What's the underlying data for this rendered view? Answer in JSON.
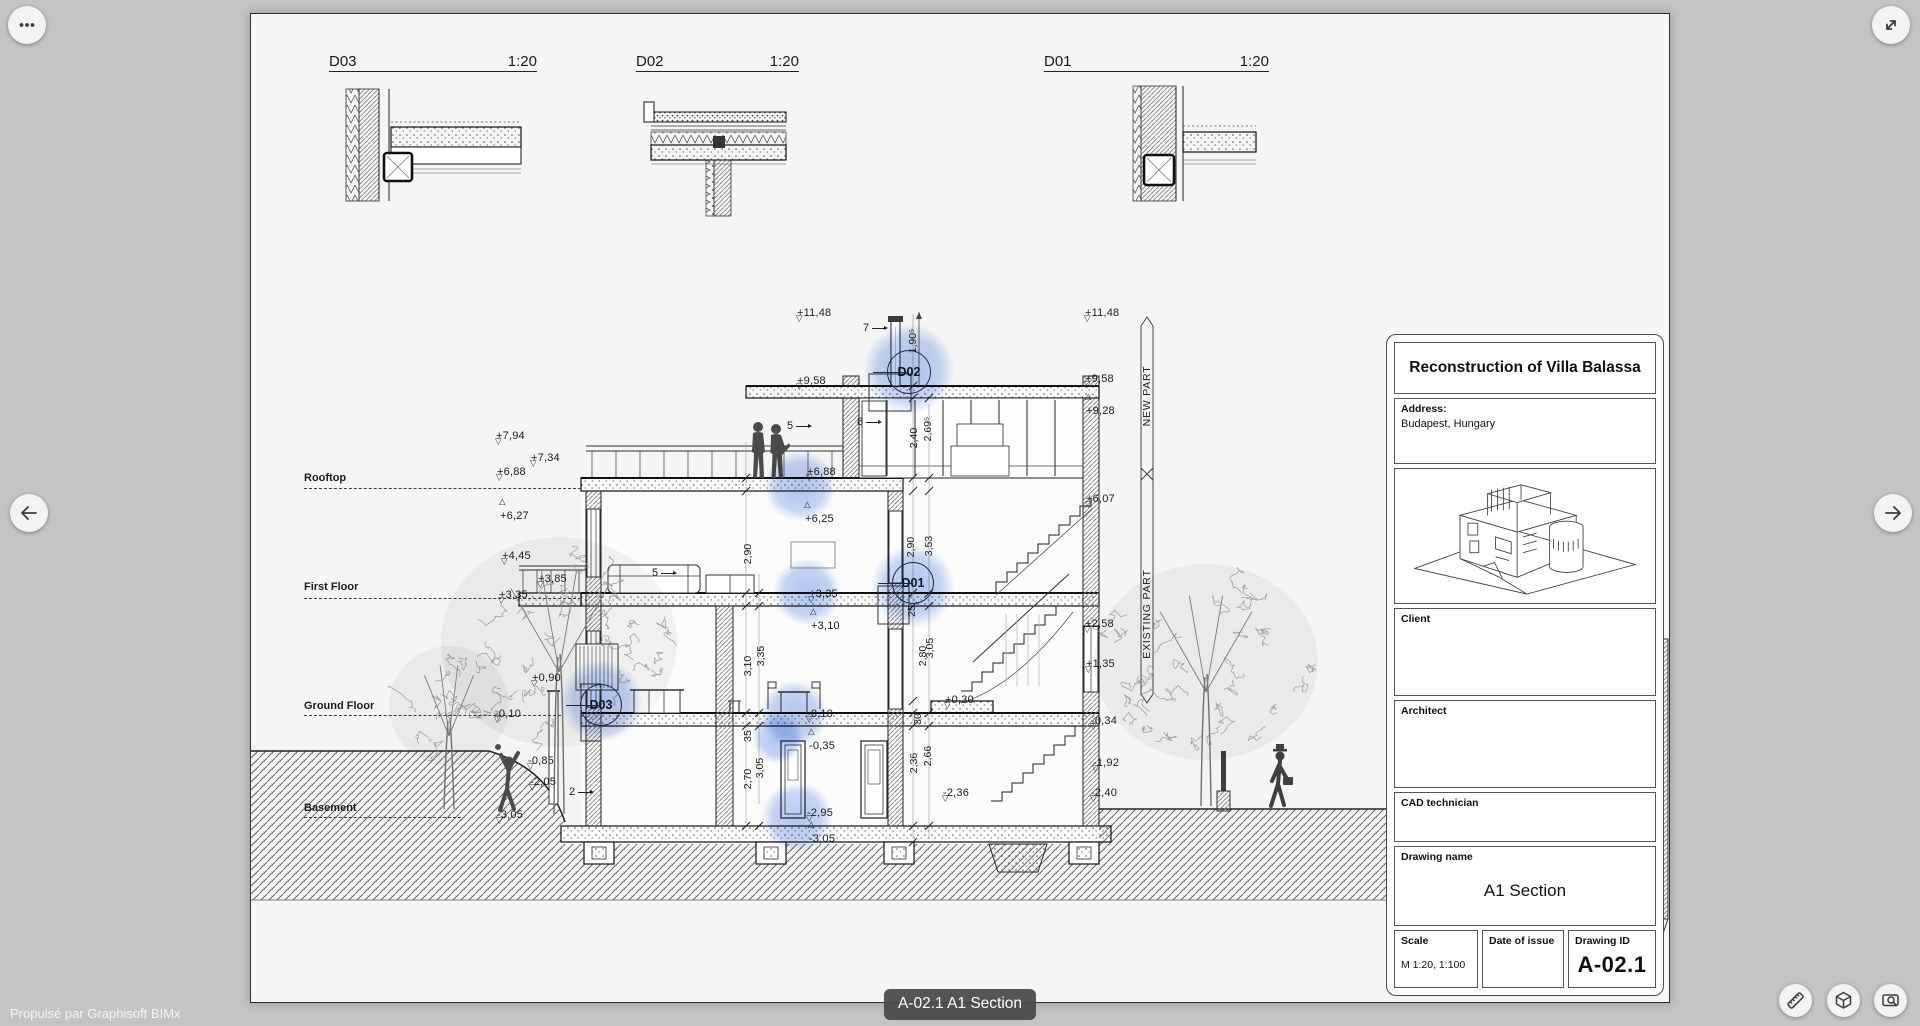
{
  "chrome": {
    "powered_by": "Propulsé par Graphisoft BIMx",
    "sheet_pill": "A-02.1 A1 Section",
    "icons": {
      "more": "more-options-icon",
      "expand": "fullscreen-expand-icon",
      "prev": "previous-sheet-arrow-icon",
      "next": "next-sheet-arrow-icon",
      "measure": "ruler-icon",
      "model": "3d-cube-icon",
      "magnify": "sheet-zoom-icon"
    }
  },
  "details": [
    {
      "id": "D03",
      "scale": "1:20",
      "x": 78,
      "w": 208
    },
    {
      "id": "D02",
      "scale": "1:20",
      "x": 385,
      "w": 163
    },
    {
      "id": "D01",
      "scale": "1:20",
      "x": 793,
      "w": 225
    }
  ],
  "section": {
    "floors": [
      {
        "label": "Rooftop",
        "x": 53,
        "y": 458,
        "ly": 474,
        "lw": 277
      },
      {
        "label": "First Floor",
        "x": 53,
        "y": 567,
        "ly": 584,
        "lw": 277
      },
      {
        "label": "Ground Floor",
        "x": 53,
        "y": 686,
        "ly": 701,
        "lw": 257
      },
      {
        "label": "Basement",
        "x": 53,
        "y": 788,
        "ly": 803,
        "lw": 157
      }
    ],
    "markers": [
      {
        "t": "+7,94",
        "x": 245,
        "y": 412,
        "d": "dn"
      },
      {
        "t": "+7,34",
        "x": 280,
        "y": 434,
        "d": "dn"
      },
      {
        "t": "+6,88",
        "x": 246,
        "y": 448,
        "d": "dn"
      },
      {
        "t": "+6,27",
        "x": 249,
        "y": 492,
        "d": "up"
      },
      {
        "t": "+4,45",
        "x": 251,
        "y": 532,
        "d": "dn"
      },
      {
        "t": "+3,85",
        "x": 287,
        "y": 555,
        "d": "dn"
      },
      {
        "t": "+3,35",
        "x": 248,
        "y": 571,
        "d": "dn"
      },
      {
        "t": "+0,90",
        "x": 281,
        "y": 654,
        "d": "dn"
      },
      {
        "t": "-0,10",
        "x": 244,
        "y": 690,
        "d": "dn"
      },
      {
        "t": "-0,85",
        "x": 277,
        "y": 737,
        "d": "dn"
      },
      {
        "t": "-2,05",
        "x": 279,
        "y": 758,
        "d": "dn"
      },
      {
        "t": "-3,05",
        "x": 246,
        "y": 791,
        "d": "dn"
      },
      {
        "t": "+11,48",
        "x": 546,
        "y": 289,
        "d": "dn"
      },
      {
        "t": "+9,58",
        "x": 546,
        "y": 357,
        "d": "dn"
      },
      {
        "t": "+6,88",
        "x": 556,
        "y": 448,
        "d": "dn"
      },
      {
        "t": "+6,25",
        "x": 554,
        "y": 495,
        "d": "up"
      },
      {
        "t": "+3,35",
        "x": 558,
        "y": 570,
        "d": "dn"
      },
      {
        "t": "+3,10",
        "x": 560,
        "y": 602,
        "d": "up"
      },
      {
        "t": "-0,10",
        "x": 556,
        "y": 690,
        "d": "dn"
      },
      {
        "t": "-0,35",
        "x": 558,
        "y": 722,
        "d": "up"
      },
      {
        "t": "-2,95",
        "x": 556,
        "y": 789,
        "d": "dn"
      },
      {
        "t": "-3,05",
        "x": 558,
        "y": 815,
        "d": "up"
      },
      {
        "t": "+0,30",
        "x": 694,
        "y": 676,
        "d": "dn"
      },
      {
        "t": "-2,36",
        "x": 692,
        "y": 769,
        "d": "dn"
      },
      {
        "t": "+11,48",
        "x": 834,
        "y": 289,
        "d": "dn"
      },
      {
        "t": "+9,58",
        "x": 834,
        "y": 355,
        "d": "dn"
      },
      {
        "t": "+9,28",
        "x": 835,
        "y": 387,
        "d": "up"
      },
      {
        "t": "+6,07",
        "x": 835,
        "y": 475,
        "d": "dn"
      },
      {
        "t": "+2,58",
        "x": 834,
        "y": 600,
        "d": "dn"
      },
      {
        "t": "+1,35",
        "x": 835,
        "y": 640,
        "d": "dn"
      },
      {
        "t": "-0,34",
        "x": 840,
        "y": 697,
        "d": "dn"
      },
      {
        "t": "-1,92",
        "x": 842,
        "y": 739,
        "d": "dn"
      },
      {
        "t": "-2,40",
        "x": 840,
        "y": 769,
        "d": "dn"
      }
    ],
    "dims": [
      {
        "t": "2,90",
        "x": 497,
        "y": 540
      },
      {
        "t": "3,10",
        "x": 497,
        "y": 652
      },
      {
        "t": "3,35",
        "x": 510,
        "y": 642
      },
      {
        "t": "35",
        "x": 497,
        "y": 722
      },
      {
        "t": "2,70",
        "x": 497,
        "y": 765
      },
      {
        "t": "3,05",
        "x": 509,
        "y": 754
      },
      {
        "t": "1,90⁵",
        "x": 662,
        "y": 327
      },
      {
        "t": "2,40",
        "x": 663,
        "y": 424
      },
      {
        "t": "2,69⁵",
        "x": 677,
        "y": 415
      },
      {
        "t": "2,90",
        "x": 660,
        "y": 533
      },
      {
        "t": "3,53",
        "x": 678,
        "y": 532
      },
      {
        "t": "25",
        "x": 661,
        "y": 597
      },
      {
        "t": "2,80",
        "x": 672,
        "y": 642
      },
      {
        "t": "3,05",
        "x": 679,
        "y": 634
      },
      {
        "t": "30",
        "x": 667,
        "y": 705
      },
      {
        "t": "2,36",
        "x": 663,
        "y": 749
      },
      {
        "t": "2,66",
        "x": 677,
        "y": 742
      }
    ],
    "callouts": [
      {
        "t": "7",
        "x": 612,
        "y": 308
      },
      {
        "t": "8",
        "x": 606,
        "y": 402
      },
      {
        "t": "5",
        "x": 536,
        "y": 406
      },
      {
        "t": "5",
        "x": 401,
        "y": 553
      },
      {
        "t": "2",
        "x": 318,
        "y": 772
      }
    ],
    "parts": [
      {
        "t": "NEW PART",
        "x": 896,
        "y": 382
      },
      {
        "t": "EXISTING PART",
        "x": 896,
        "y": 600
      }
    ],
    "detail_markers": [
      {
        "t": "D02",
        "x": 658,
        "y": 358,
        "r": 21
      },
      {
        "t": "D01",
        "x": 662,
        "y": 569,
        "r": 20
      },
      {
        "t": "D03",
        "x": 350,
        "y": 691,
        "r": 20
      }
    ],
    "hotspots": [
      {
        "x": 658,
        "y": 355,
        "r": 46
      },
      {
        "x": 662,
        "y": 572,
        "r": 42
      },
      {
        "x": 350,
        "y": 687,
        "r": 42
      },
      {
        "x": 549,
        "y": 472,
        "r": 36
      },
      {
        "x": 556,
        "y": 578,
        "r": 34
      },
      {
        "x": 543,
        "y": 700,
        "r": 34
      },
      {
        "x": 527,
        "y": 724,
        "r": 26
      },
      {
        "x": 546,
        "y": 803,
        "r": 36
      }
    ]
  },
  "titleblock": {
    "project_title": "Reconstruction of Villa Balassa",
    "address_label": "Address:",
    "address_value": "Budapest, Hungary",
    "client_label": "Client",
    "architect_label": "Architect",
    "cad_label": "CAD technician",
    "drawing_name_label": "Drawing name",
    "drawing_name": "A1 Section",
    "scale_label": "Scale",
    "scale_value": "M 1:20, 1:100",
    "date_label": "Date of issue",
    "id_label": "Drawing ID",
    "drawing_id": "A-02.1"
  }
}
